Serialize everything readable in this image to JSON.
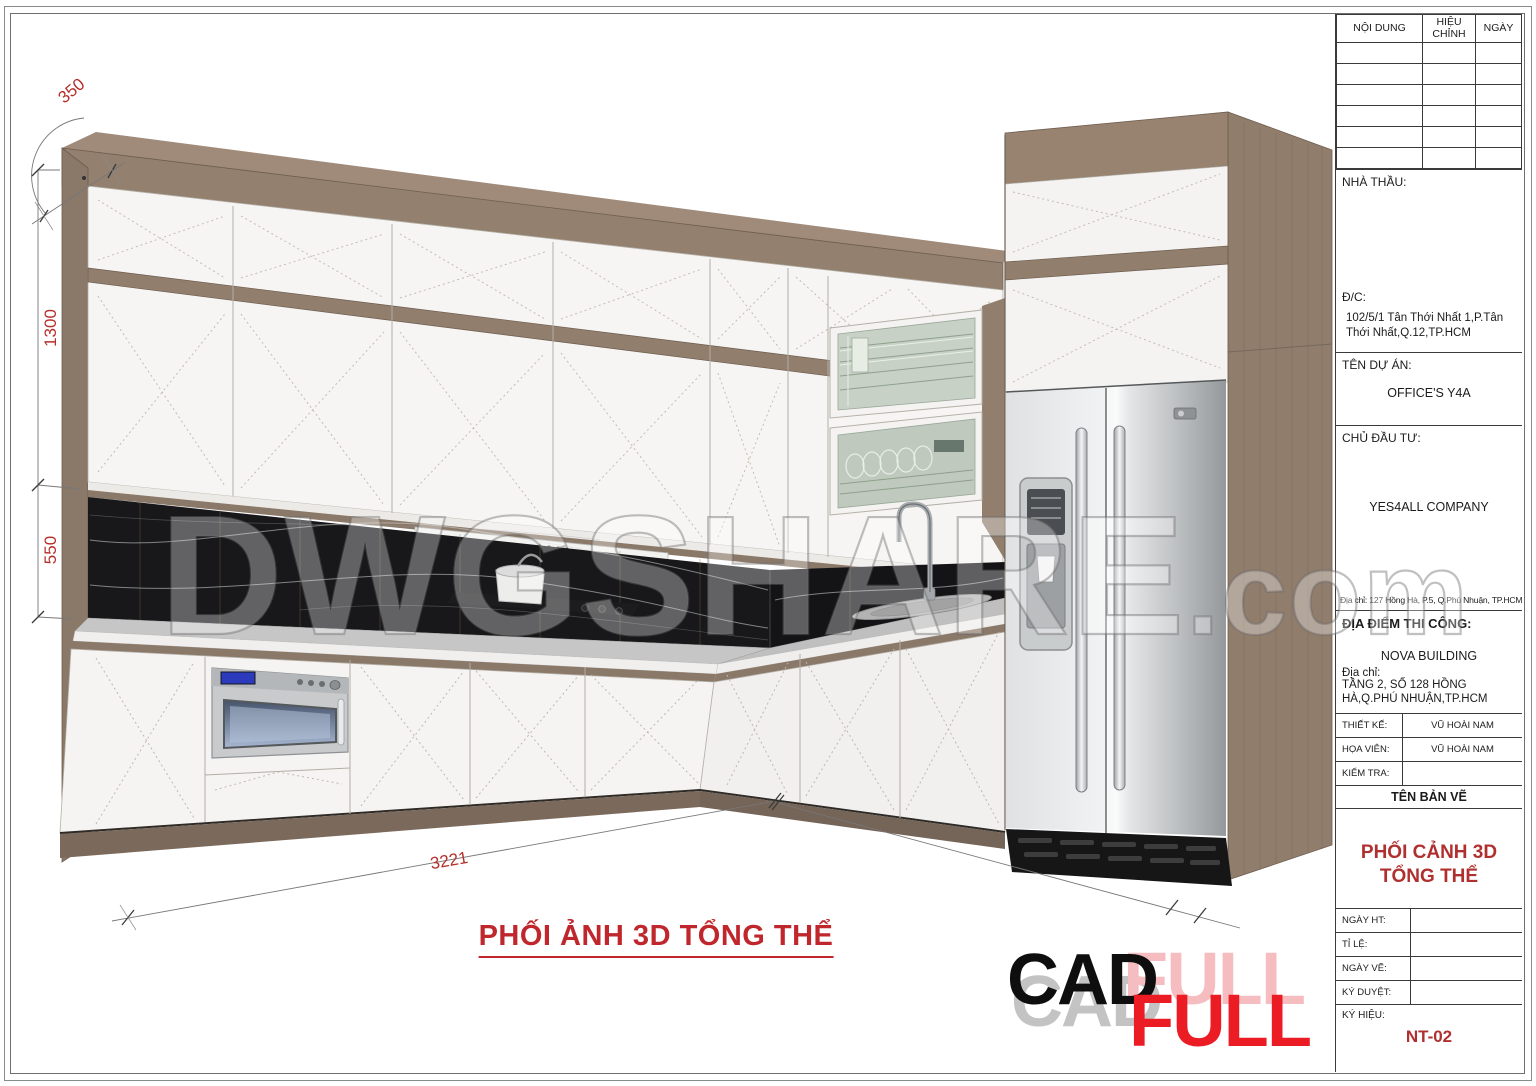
{
  "sheet": {
    "caption": "PHỐI ẢNH 3D TỔNG THỂ"
  },
  "dimensions": {
    "depth_top": "350",
    "upper_height": "1300",
    "backsplash_height": "550",
    "run_length": "3221"
  },
  "watermark": {
    "main": "DWGSHARE",
    "suffix": ".com"
  },
  "logo": {
    "cad": "CAD",
    "full": "FULL"
  },
  "title_block": {
    "revision": {
      "col_content": "NỘI DUNG",
      "col_revision": "HIỆU CHỈNH",
      "col_date": "NGÀY"
    },
    "contractor_label": "NHÀ THẦU:",
    "address_label": "Đ/C:",
    "contractor_address": "102/5/1 Tân Thới Nhất 1,P.Tân Thới Nhất,Q.12,TP.HCM",
    "project_label": "TÊN DỰ ÁN:",
    "project_name": "OFFICE'S Y4A",
    "investor_label": "CHỦ ĐẦU TƯ:",
    "investor_name": "YES4ALL COMPANY",
    "investor_address": "Địa chỉ:  127 Hồng Hà, P.5, Q.Phú Nhuận, TP.HCM",
    "site_label": "ĐỊA ĐIỂM THI CÔNG:",
    "site_name": "NOVA BUILDING",
    "site_address_label": "Địa chỉ:",
    "site_address": "TẦNG 2, SỐ 128 HỒNG HÀ,Q.PHÚ NHUẬN,TP.HCM",
    "designer_label": "THIẾT KẾ:",
    "designer_name": "VŨ HOÀI NAM",
    "drafter_label": "HỌA VIÊN:",
    "drafter_name": "VŨ HOÀI NAM",
    "checker_label": "KIỂM TRA:",
    "drawing_name_header": "TÊN BẢN VẼ",
    "drawing_name": "PHỐI CẢNH 3D TỔNG THỂ",
    "finish_date_label": "NGÀY HT:",
    "scale_label": "TỈ LỆ:",
    "draw_date_label": "NGÀY VẼ:",
    "approval_label": "KÝ DUYỆT:",
    "code_label": "KÝ HIỆU:",
    "code_value": "NT-02"
  },
  "colors": {
    "accent_red": "#c0272d",
    "dim_red": "#b5302b",
    "wood": "#8f7d6e",
    "marble_black": "#18181b"
  }
}
